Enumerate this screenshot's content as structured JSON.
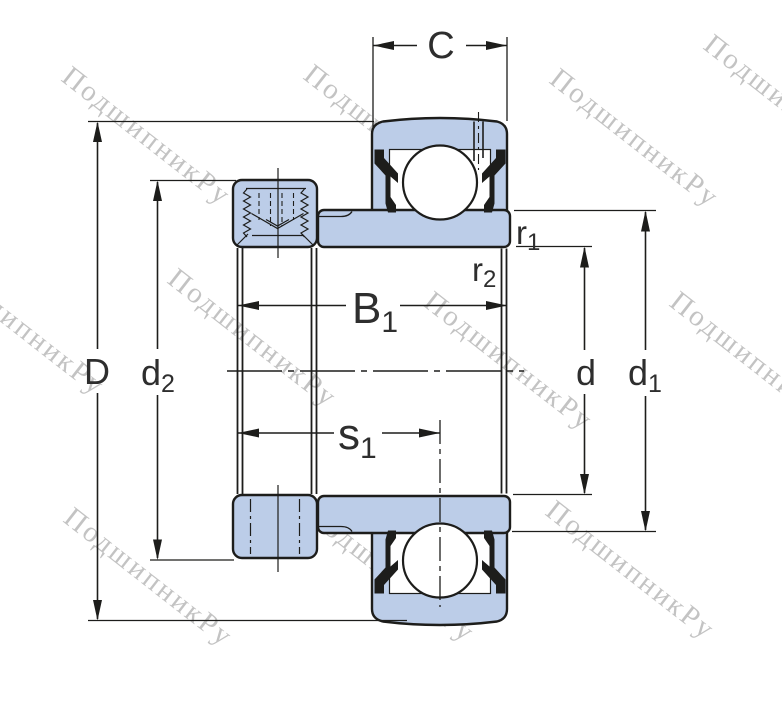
{
  "watermark": {
    "text": "ПодшипникРу"
  },
  "colors": {
    "bearing_fill": "#bccde8",
    "line_color": "#1d1d1b",
    "label_color": "#2e2e2e",
    "watermark_color": "#6f6f6f"
  },
  "dimensions": {
    "C": {
      "base": "C",
      "sub": ""
    },
    "B1": {
      "base": "B",
      "sub": "1"
    },
    "s1": {
      "base": "s",
      "sub": "1"
    },
    "D": {
      "base": "D",
      "sub": ""
    },
    "d2": {
      "base": "d",
      "sub": "2"
    },
    "d": {
      "base": "d",
      "sub": ""
    },
    "d1": {
      "base": "d",
      "sub": "1"
    },
    "r1": {
      "base": "r",
      "sub": "1"
    },
    "r2": {
      "base": "r",
      "sub": "2"
    }
  }
}
